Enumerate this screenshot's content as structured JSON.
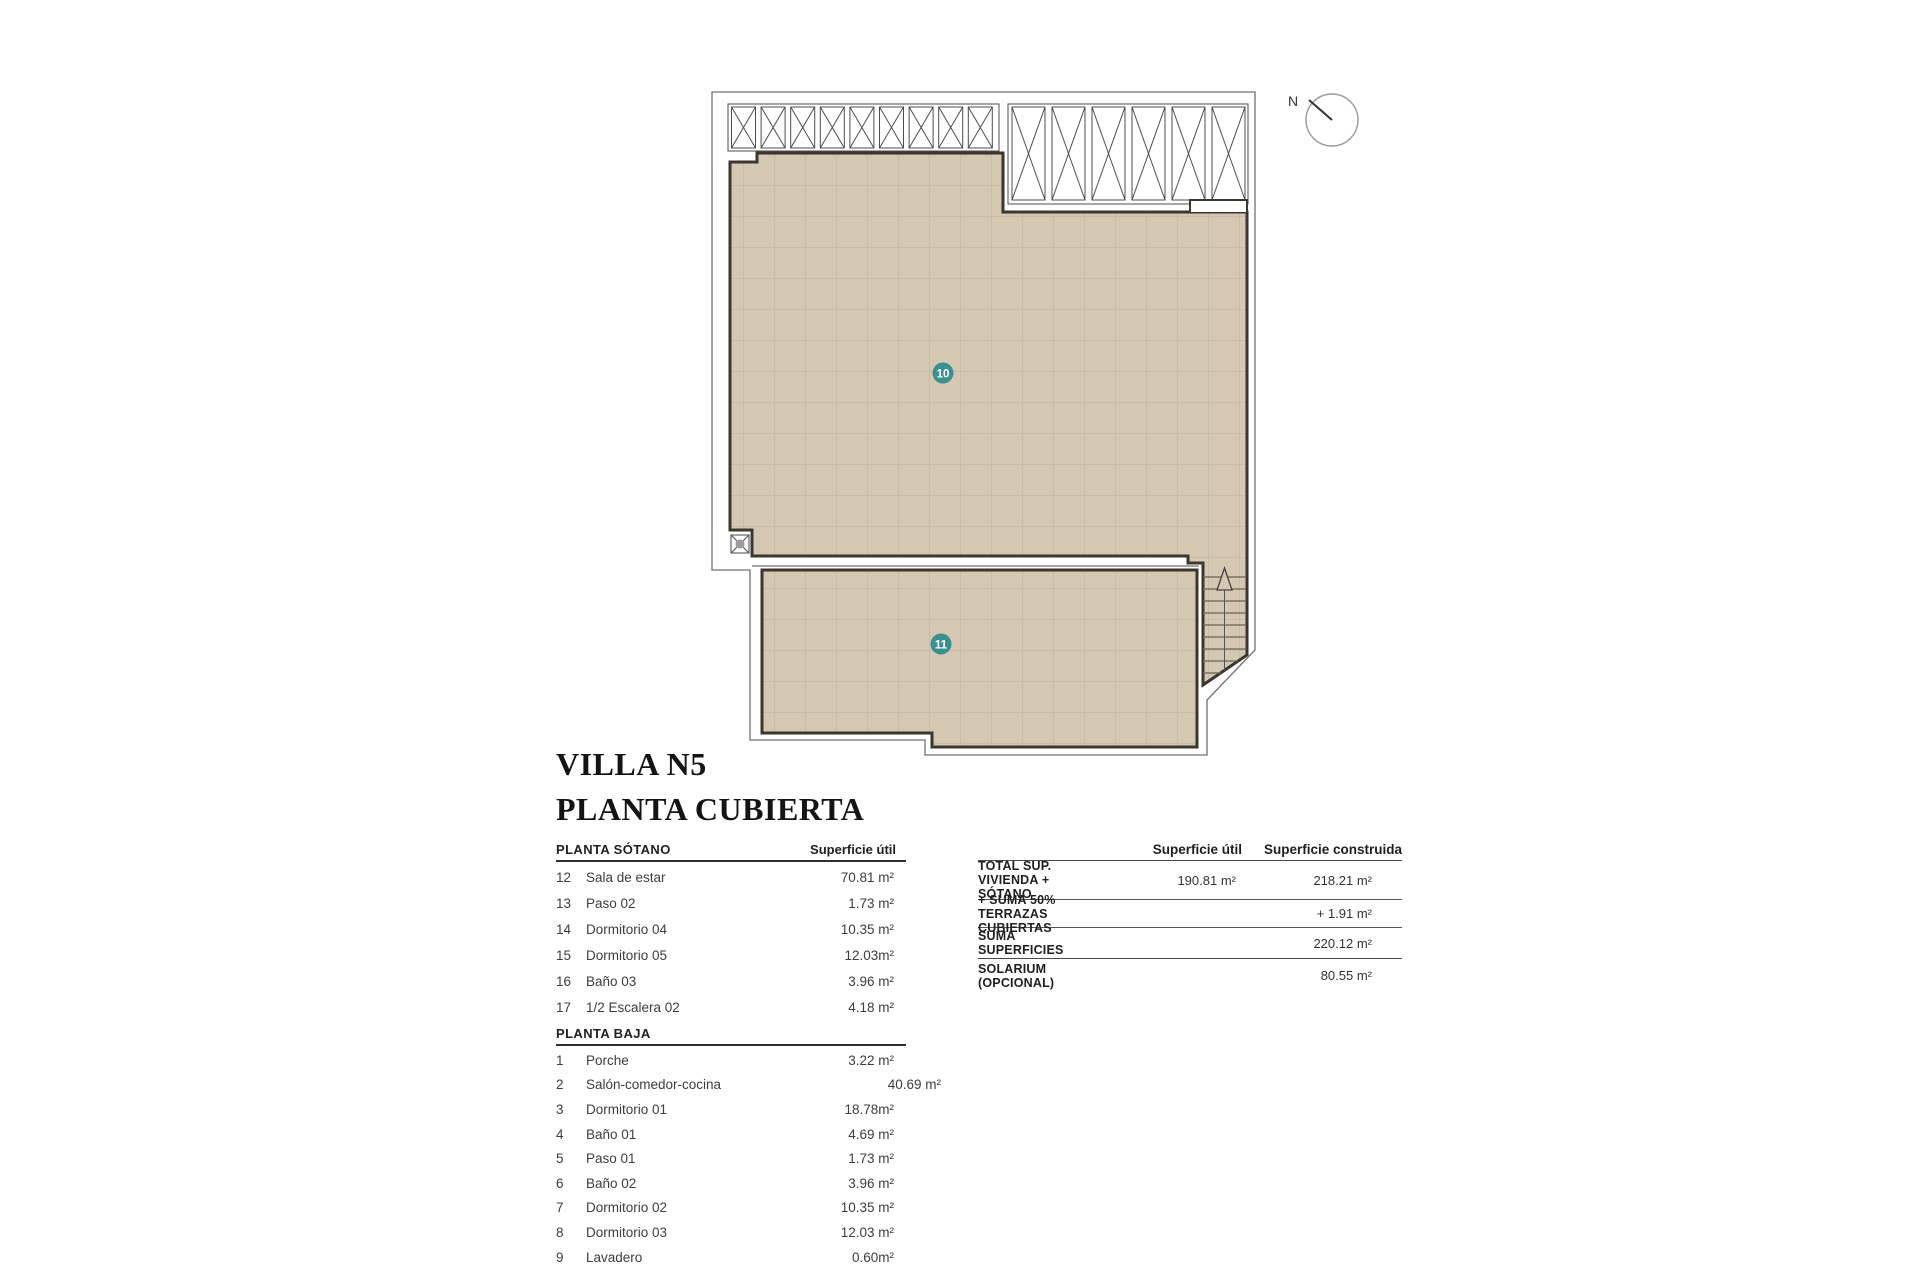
{
  "title": {
    "line1": "VILLA N5",
    "line2": "PLANTA CUBIERTA"
  },
  "plan": {
    "north_label": "N",
    "area_labels": [
      {
        "id": "10",
        "meaning": "terrace-roof-area"
      },
      {
        "id": "11",
        "meaning": "terrace-roof-area"
      }
    ]
  },
  "colors": {
    "tile_fill": "#d5c8b3",
    "tile_grid": "#c2b29a",
    "wall": "#3b362e",
    "thin_line": "#707070",
    "label_teal": "#3a9090",
    "text_dark": "#1f1f1f"
  },
  "rooms_table": {
    "sections": [
      {
        "heading": "PLANTA SÓTANO",
        "col_header": "Superficie útil",
        "rows": [
          {
            "num": "12",
            "name": "Sala de estar",
            "value": "70.81 m²"
          },
          {
            "num": "13",
            "name": "Paso 02",
            "value": "1.73 m²"
          },
          {
            "num": "14",
            "name": "Dormitorio 04",
            "value": "10.35 m²"
          },
          {
            "num": "15",
            "name": "Dormitorio 05",
            "value": "12.03m²"
          },
          {
            "num": "16",
            "name": "Baño 03",
            "value": "3.96 m²"
          },
          {
            "num": "17",
            "name": "1/2 Escalera 02",
            "value": "4.18 m²"
          }
        ]
      },
      {
        "heading": "PLANTA BAJA",
        "rows": [
          {
            "num": "1",
            "name": "Porche",
            "value": "3.22 m²"
          },
          {
            "num": "2",
            "name": "Salón-comedor-cocina",
            "value": "40.69 m²"
          },
          {
            "num": "3",
            "name": "Dormitorio 01",
            "value": "18.78m²"
          },
          {
            "num": "4",
            "name": "Baño 01",
            "value": "4.69 m²"
          },
          {
            "num": "5",
            "name": "Paso 01",
            "value": "1.73 m²"
          },
          {
            "num": "6",
            "name": "Baño 02",
            "value": "3.96 m²"
          },
          {
            "num": "7",
            "name": "Dormitorio 02",
            "value": "10.35 m²"
          },
          {
            "num": "8",
            "name": "Dormitorio 03",
            "value": "12.03 m²"
          },
          {
            "num": "9",
            "name": "Lavadero",
            "value": "0.60m²"
          }
        ]
      }
    ]
  },
  "summary_table": {
    "col_util": "Superficie útil",
    "col_construida": "Superficie construida",
    "rows": [
      {
        "label": "TOTAL SUP. VIVIENDA + SÓTANO",
        "util": "190.81 m²",
        "construida": "218.21 m²"
      },
      {
        "label": "+ SUMA 50% TERRAZAS CUBIERTAS",
        "util": "",
        "construida": "+ 1.91 m²"
      },
      {
        "label": "SUMA SUPERFICIES",
        "util": "",
        "construida": "220.12 m²"
      },
      {
        "label": "SOLARIUM (OPCIONAL)",
        "util": "",
        "construida": "80.55 m²"
      }
    ]
  }
}
